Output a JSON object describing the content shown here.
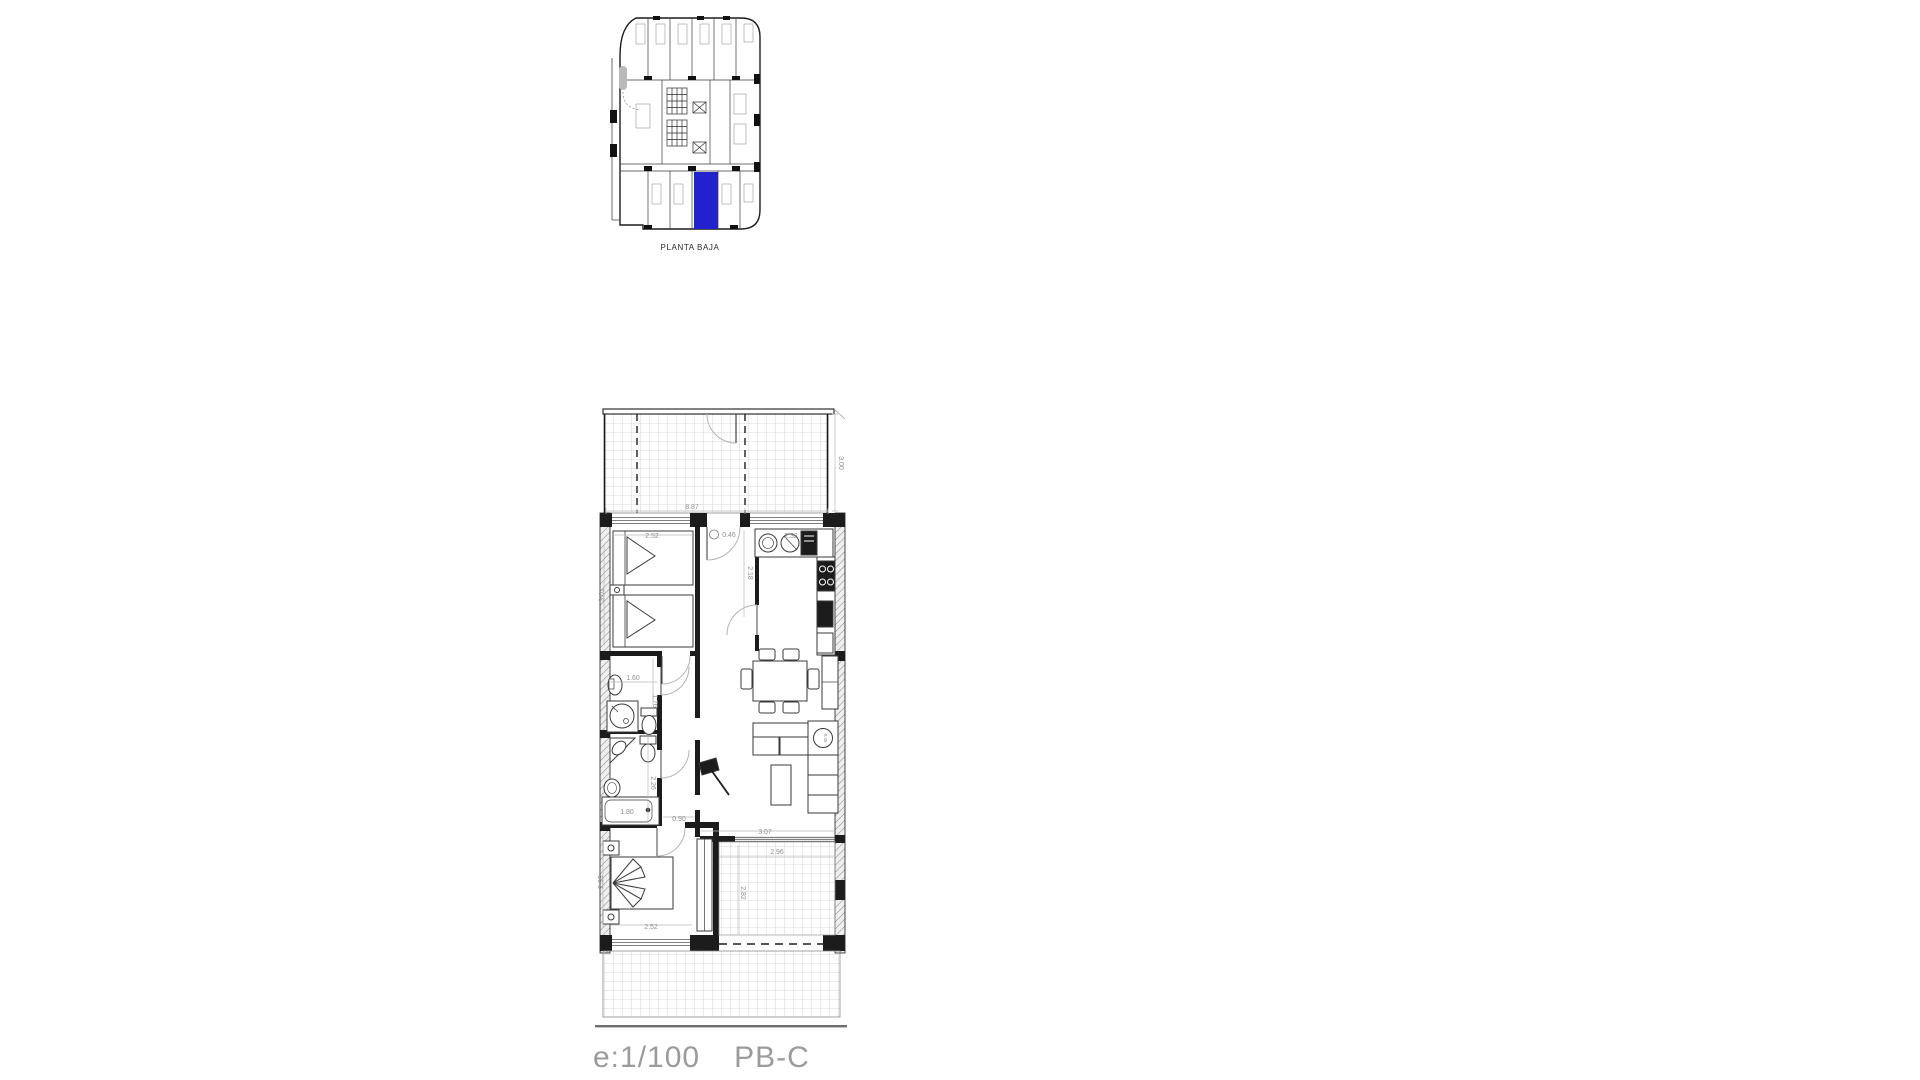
{
  "site_plan": {
    "title": "PLANTA BAJA",
    "highlight_color": "#2121cd"
  },
  "floor_plan": {
    "dims": {
      "terrace_width": "8.87",
      "terrace_depth": "3.00",
      "bedroom1_width": "2.52",
      "bedroom1_depth": "3.01",
      "closet_width": "0.46",
      "hall_depth": "2.18",
      "kitchen_width": "2.32",
      "bath1_width": "1.60",
      "bath1_depth": "1.76",
      "bath2_depth": "2.26",
      "bathtub_length": "1.80",
      "corridor_width": "0.90",
      "side_table": "0.45",
      "living_width": "3.07",
      "bedroom2_width": "2.52",
      "bedroom2_depth": "2.99",
      "terrace_inner_width": "2.96",
      "terrace_inner_depth": "2.82"
    }
  },
  "footer": {
    "scale": "e:1/100",
    "plan_code": "PB-C"
  },
  "colors": {
    "highlight": "#2121cd",
    "wall": "#1c1c1c",
    "dim_text": "#8f8f8f",
    "footer_text": "#9b9b9b"
  }
}
